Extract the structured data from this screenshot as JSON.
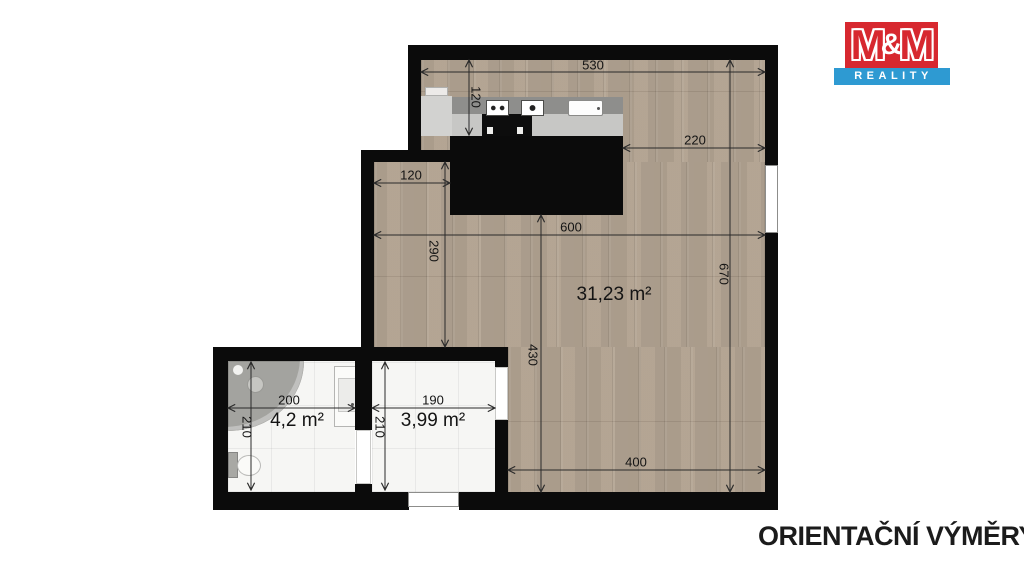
{
  "logo": {
    "m_left": "M",
    "ampersand": "&",
    "m_right": "M",
    "banner": "REALITY"
  },
  "caption": "ORIENTAČNÍ VÝMĚRY",
  "areas": {
    "living": "31,23 m²",
    "bathroom": "4,2 m²",
    "hall": "3,99 m²"
  },
  "dimensions": {
    "d530": "530",
    "d120_kitchen": "120",
    "d220": "220",
    "d120_ext": "120",
    "d290": "290",
    "d600": "600",
    "d670": "670",
    "d430": "430",
    "d400": "400",
    "d200": "200",
    "d210_bath": "210",
    "d190": "190",
    "d210_hall": "210"
  },
  "colors": {
    "wall": "#0b0b0b",
    "wood_floor": "#b5a796",
    "tile_floor": "#f6f6f4",
    "logo_red": "#d7282f",
    "logo_blue": "#2e9ad2",
    "dim_line": "#2a2a2a"
  }
}
